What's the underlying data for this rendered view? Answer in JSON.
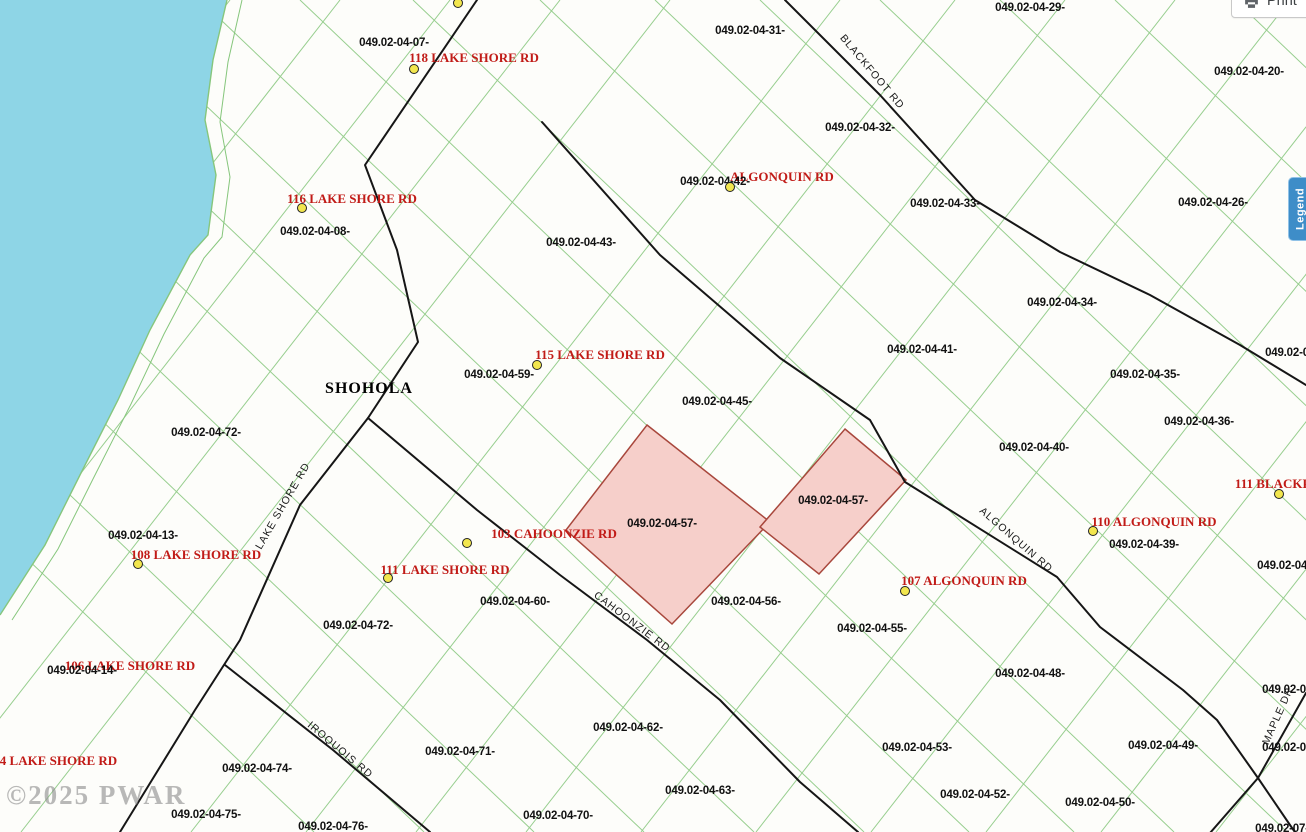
{
  "map": {
    "town": {
      "label": "SHOHOLA"
    },
    "watermark": {
      "text": "©2025 PWAR"
    },
    "colors": {
      "water": "#8ed5e6",
      "parcel_line": "#86c67c",
      "road": "#161616",
      "highlight_fill": "#f6cfca",
      "highlight_border": "#a8473c",
      "address_text": "#c11b17",
      "marker_fill": "#f2e64e",
      "parcel_text": "#111111",
      "road_text": "#1a1a1a",
      "town_text": "#000000",
      "watermark_text": "#8f8f8f",
      "legend_bg": "#3e8dc8",
      "legend_border": "#90c2e7"
    },
    "highlighted_parcel_ids": [
      "049.02-04-57-",
      "049.02-04-57-"
    ],
    "parcel_labels": [
      {
        "text": "049.02-04-07-",
        "x": 394,
        "y": 43
      },
      {
        "text": "049.02-04-31-",
        "x": 750,
        "y": 31
      },
      {
        "text": "049.02-04-29-",
        "x": 1030,
        "y": 8
      },
      {
        "text": "049.02-04-20-",
        "x": 1249,
        "y": 72
      },
      {
        "text": "049.02-04-32-",
        "x": 860,
        "y": 128
      },
      {
        "text": "049.02-04-42-",
        "x": 715,
        "y": 182
      },
      {
        "text": "049.02-04-33-",
        "x": 945,
        "y": 204
      },
      {
        "text": "049.02-04-26-",
        "x": 1213,
        "y": 203
      },
      {
        "text": "049.02-04-08-",
        "x": 315,
        "y": 232
      },
      {
        "text": "049.02-04-43-",
        "x": 581,
        "y": 243
      },
      {
        "text": "049.02-04-34-",
        "x": 1062,
        "y": 303
      },
      {
        "text": "049.02-0",
        "x": 1287,
        "y": 353
      },
      {
        "text": "049.02-04-41-",
        "x": 922,
        "y": 350
      },
      {
        "text": "049.02-04-59-",
        "x": 499,
        "y": 375
      },
      {
        "text": "049.02-04-35-",
        "x": 1145,
        "y": 375
      },
      {
        "text": "049.02-04-45-",
        "x": 717,
        "y": 402
      },
      {
        "text": "049.02-04-36-",
        "x": 1199,
        "y": 422
      },
      {
        "text": "049.02-04-40-",
        "x": 1034,
        "y": 448
      },
      {
        "text": "049.02-04-72-",
        "x": 206,
        "y": 433
      },
      {
        "text": "049.02-04-13-",
        "x": 143,
        "y": 536
      },
      {
        "text": "049.02-04-57-",
        "x": 662,
        "y": 524
      },
      {
        "text": "049.02-04-57-",
        "x": 833,
        "y": 501
      },
      {
        "text": "049.02-04-39-",
        "x": 1144,
        "y": 545
      },
      {
        "text": "049.02-04-37-",
        "x": 1292,
        "y": 566
      },
      {
        "text": "049.02-04-60-",
        "x": 515,
        "y": 602
      },
      {
        "text": "049.02-04-56-",
        "x": 746,
        "y": 602
      },
      {
        "text": "049.02-04-55-",
        "x": 872,
        "y": 629
      },
      {
        "text": "049.02-04-72-",
        "x": 358,
        "y": 626
      },
      {
        "text": "049.02-04-14-",
        "x": 82,
        "y": 671
      },
      {
        "text": "049.02-04-48-",
        "x": 1030,
        "y": 674
      },
      {
        "text": "049.02-0",
        "x": 1284,
        "y": 690
      },
      {
        "text": "049.02-04-62-",
        "x": 628,
        "y": 728
      },
      {
        "text": "049.02-04-71-",
        "x": 460,
        "y": 752
      },
      {
        "text": "049.02-04-74-",
        "x": 257,
        "y": 769
      },
      {
        "text": "049.02-04-53-",
        "x": 917,
        "y": 748
      },
      {
        "text": "049.02-04-49-",
        "x": 1163,
        "y": 746
      },
      {
        "text": "049.02-0",
        "x": 1284,
        "y": 748
      },
      {
        "text": "049.02-04-63-",
        "x": 700,
        "y": 791
      },
      {
        "text": "049.02-04-75-",
        "x": 206,
        "y": 815
      },
      {
        "text": "049.02-04-70-",
        "x": 558,
        "y": 816
      },
      {
        "text": "049.02-04-52-",
        "x": 975,
        "y": 795
      },
      {
        "text": "049.02-04-50-",
        "x": 1100,
        "y": 803
      },
      {
        "text": "049.02-04-76-",
        "x": 333,
        "y": 827
      },
      {
        "text": "049.02-07-44-",
        "x": 1290,
        "y": 829
      }
    ],
    "address_labels": [
      {
        "text": "118 LAKE SHORE RD",
        "x": 474,
        "y": 58
      },
      {
        "text": "116 LAKE SHORE RD",
        "x": 352,
        "y": 199
      },
      {
        "text": "ALGONQUIN RD",
        "x": 782,
        "y": 177
      },
      {
        "text": "115 LAKE SHORE RD",
        "x": 600,
        "y": 355
      },
      {
        "text": "108 LAKE SHORE RD",
        "x": 196,
        "y": 555
      },
      {
        "text": "103 CAHOONZIE RD",
        "x": 554,
        "y": 534
      },
      {
        "text": "111 LAKE SHORE RD",
        "x": 445,
        "y": 570
      },
      {
        "text": "110 ALGONQUIN RD",
        "x": 1154,
        "y": 522
      },
      {
        "text": "111 BLACKFOOT RD",
        "x": 1298,
        "y": 484
      },
      {
        "text": "107 ALGONQUIN RD",
        "x": 964,
        "y": 581
      },
      {
        "text": "106 LAKE SHORE RD",
        "x": 130,
        "y": 666
      },
      {
        "text": "104 LAKE SHORE RD",
        "x": 52,
        "y": 761
      }
    ],
    "road_labels": [
      {
        "text": "BLACKFOOT RD",
        "x": 872,
        "y": 72,
        "angle": 50
      },
      {
        "text": "LAKE SHORE RD",
        "x": 283,
        "y": 506,
        "angle": -60
      },
      {
        "text": "ALGONQUIN RD",
        "x": 1016,
        "y": 540,
        "angle": 41
      },
      {
        "text": "CAHOONZIE RD",
        "x": 632,
        "y": 622,
        "angle": 37
      },
      {
        "text": "IROQUOIS RD",
        "x": 340,
        "y": 750,
        "angle": 40
      },
      {
        "text": "MAPLE DR",
        "x": 1278,
        "y": 716,
        "angle": -66
      }
    ],
    "markers": [
      {
        "x": 458,
        "y": 3
      },
      {
        "x": 414,
        "y": 69
      },
      {
        "x": 302,
        "y": 208
      },
      {
        "x": 730,
        "y": 187
      },
      {
        "x": 537,
        "y": 365
      },
      {
        "x": 1279,
        "y": 494
      },
      {
        "x": 1093,
        "y": 531
      },
      {
        "x": 138,
        "y": 564
      },
      {
        "x": 467,
        "y": 543
      },
      {
        "x": 388,
        "y": 578
      },
      {
        "x": 905,
        "y": 591
      }
    ]
  },
  "controls": {
    "print_label": "Print",
    "legend_label": "Legend"
  }
}
